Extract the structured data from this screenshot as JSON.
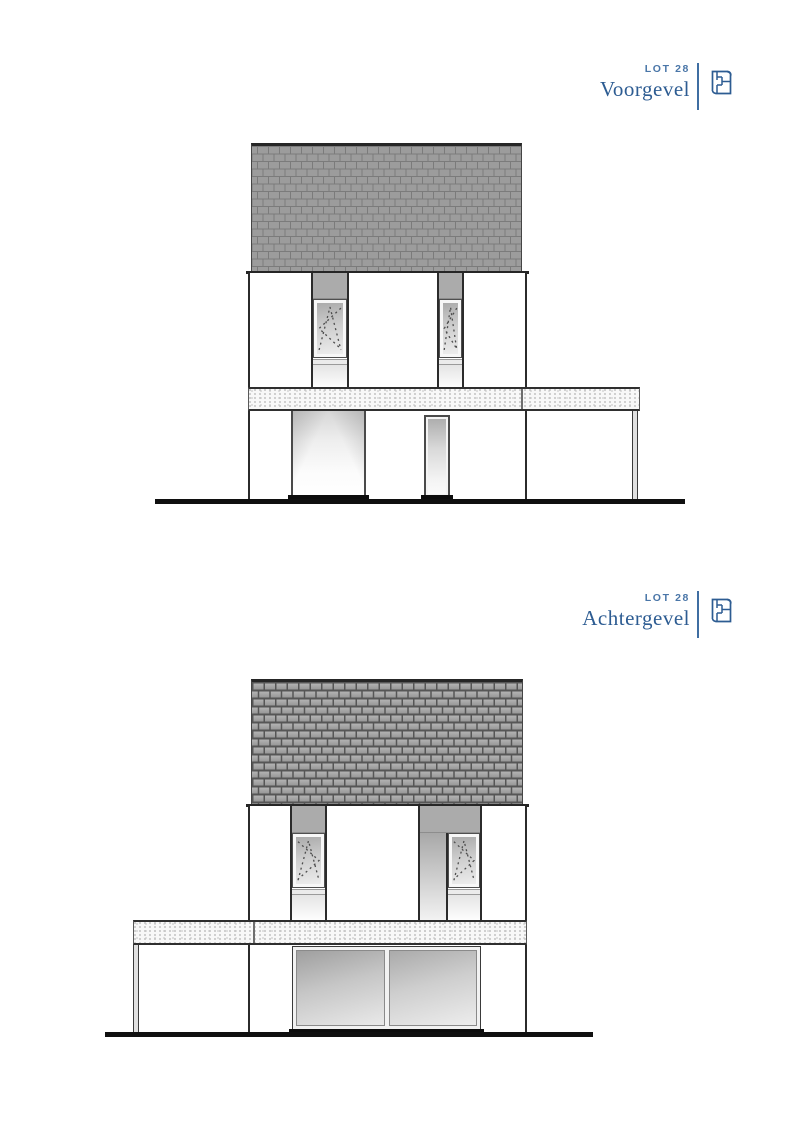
{
  "document": {
    "type": "architectural-elevation-sheet"
  },
  "colors": {
    "accent_blue": "#2d5c92",
    "lot_label_blue": "#4a76a8",
    "roof_tile_gray": "#9c9c9c",
    "roof_joint_dark": "#565656",
    "wall_white": "#ffffff",
    "recess_gray": "#ababab",
    "outline_dark": "#2b2b2b",
    "canopy_speckle": "#c4c4c4",
    "ground_black": "#101010"
  },
  "views": [
    {
      "id": "voorgevel",
      "lot_label": "LOT 28",
      "title": "Voorgevel",
      "icon": "floorplan-icon"
    },
    {
      "id": "achtergevel",
      "lot_label": "LOT 28",
      "title": "Achtergevel",
      "icon": "floorplan-icon"
    }
  ]
}
